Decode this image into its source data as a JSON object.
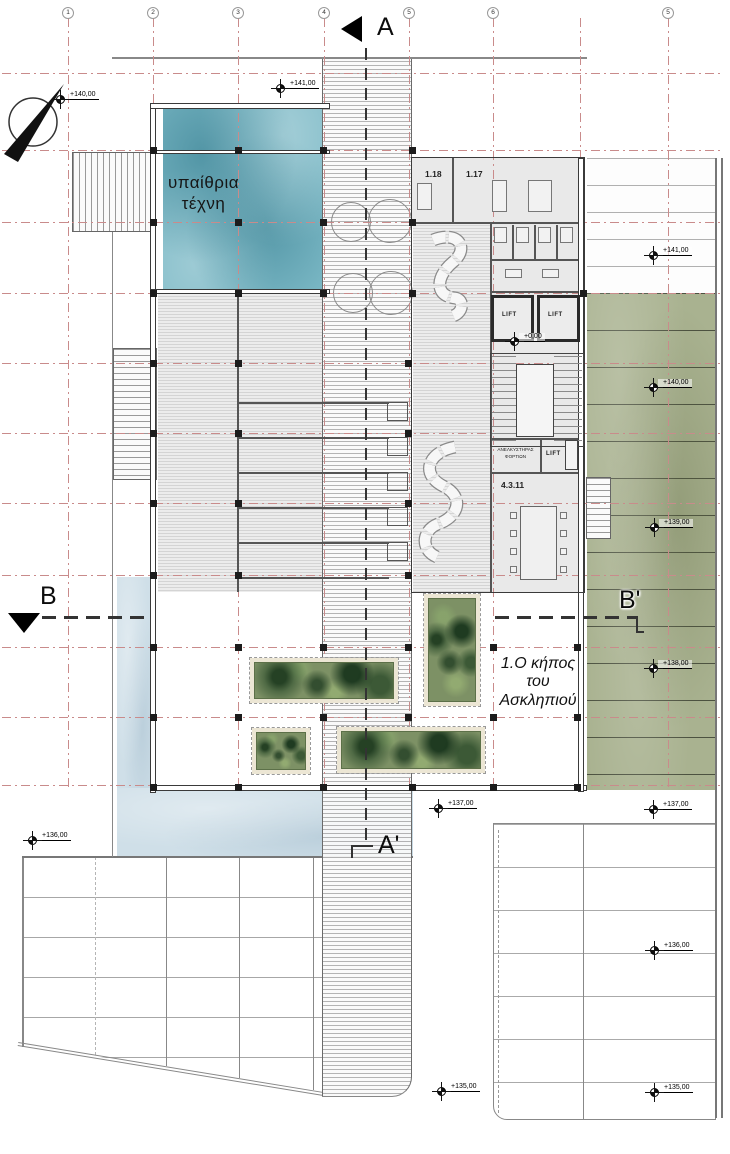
{
  "plan": {
    "area_labels": {
      "open_air_art_line1": "υπαίθρια",
      "open_air_art_line2": "τέχνη",
      "garden_line1": "1.Ο κήπος",
      "garden_line2": "του",
      "garden_line3": "Ασκληπιού"
    },
    "rooms": {
      "office_a": "1.18",
      "office_b": "1.17",
      "meeting": "4.3.11",
      "lift_left": "LIFT",
      "lift_right": "LIFT",
      "lift_service": "LIFT",
      "freight_lift_line1": "ΑΝΕΛΚΥΣΤΗΡΑΣ",
      "freight_lift_line2": "ΦΟΡΤΙΩΝ"
    },
    "sections": {
      "a": "A",
      "a_prime": "A'",
      "b": "B",
      "b_prime": "B'"
    },
    "grid_bubbles": [
      "1",
      "2",
      "3",
      "4",
      "5",
      "6",
      "5"
    ],
    "levels": [
      "+140,00",
      "+141,00",
      "+0,00",
      "+141,00",
      "+140,00",
      "+139,00",
      "+138,00",
      "+137,00",
      "+137,00",
      "+136,00",
      "+136,00",
      "+135,00",
      "+135,00"
    ],
    "colors": {
      "pool_teal": "#7cb9c6",
      "water_light": "#cfdfe8",
      "terrace_green": "#a9b290",
      "planter_green": "#7d9165",
      "grid_red": "#c98b8b"
    }
  }
}
